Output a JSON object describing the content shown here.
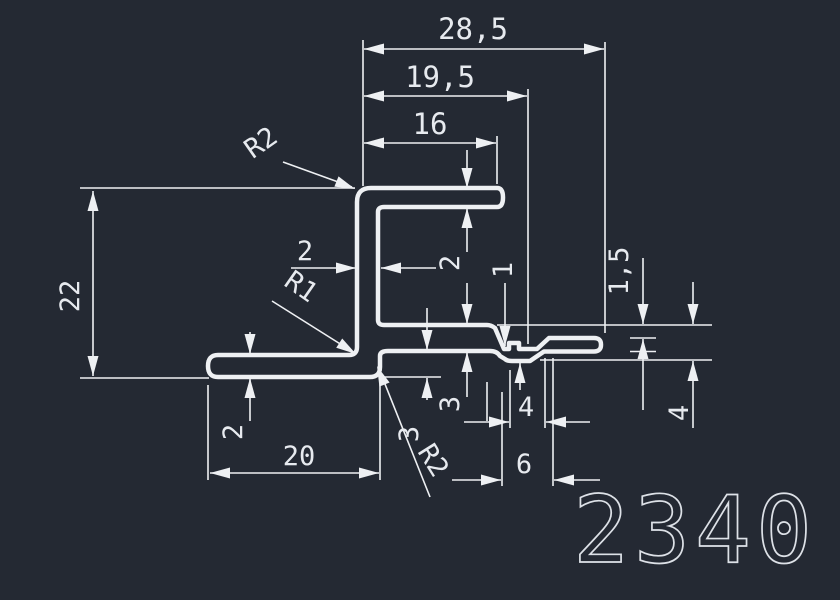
{
  "drawing": {
    "part_number": "2340",
    "type_label": "profile-cross-section"
  },
  "colors": {
    "background": "#242933",
    "line": "#eef0f3",
    "text": "#e7eaef"
  },
  "dimensions": {
    "width_total": {
      "label": "28,5"
    },
    "width_upper": {
      "label": "19,5"
    },
    "width_flange": {
      "label": "16"
    },
    "stem_thickness": {
      "label": "2"
    },
    "flange_thickness": {
      "label": "2"
    },
    "arm_thickness": {
      "label": "3"
    },
    "arm_gap": {
      "label": "3"
    },
    "notch_thickness": {
      "label": "1"
    },
    "arm_drop": {
      "label": "1,5"
    },
    "height_total": {
      "label": "22"
    },
    "base_thickness": {
      "label": "2"
    },
    "base_length": {
      "label": "20"
    },
    "step_width": {
      "label": "4"
    },
    "step_total_width": {
      "label": "6"
    },
    "step_depth": {
      "label": "4"
    },
    "radius_top": {
      "label": "R2"
    },
    "radius_inner": {
      "label": "R1"
    },
    "radius_corner": {
      "label": "R2"
    }
  }
}
